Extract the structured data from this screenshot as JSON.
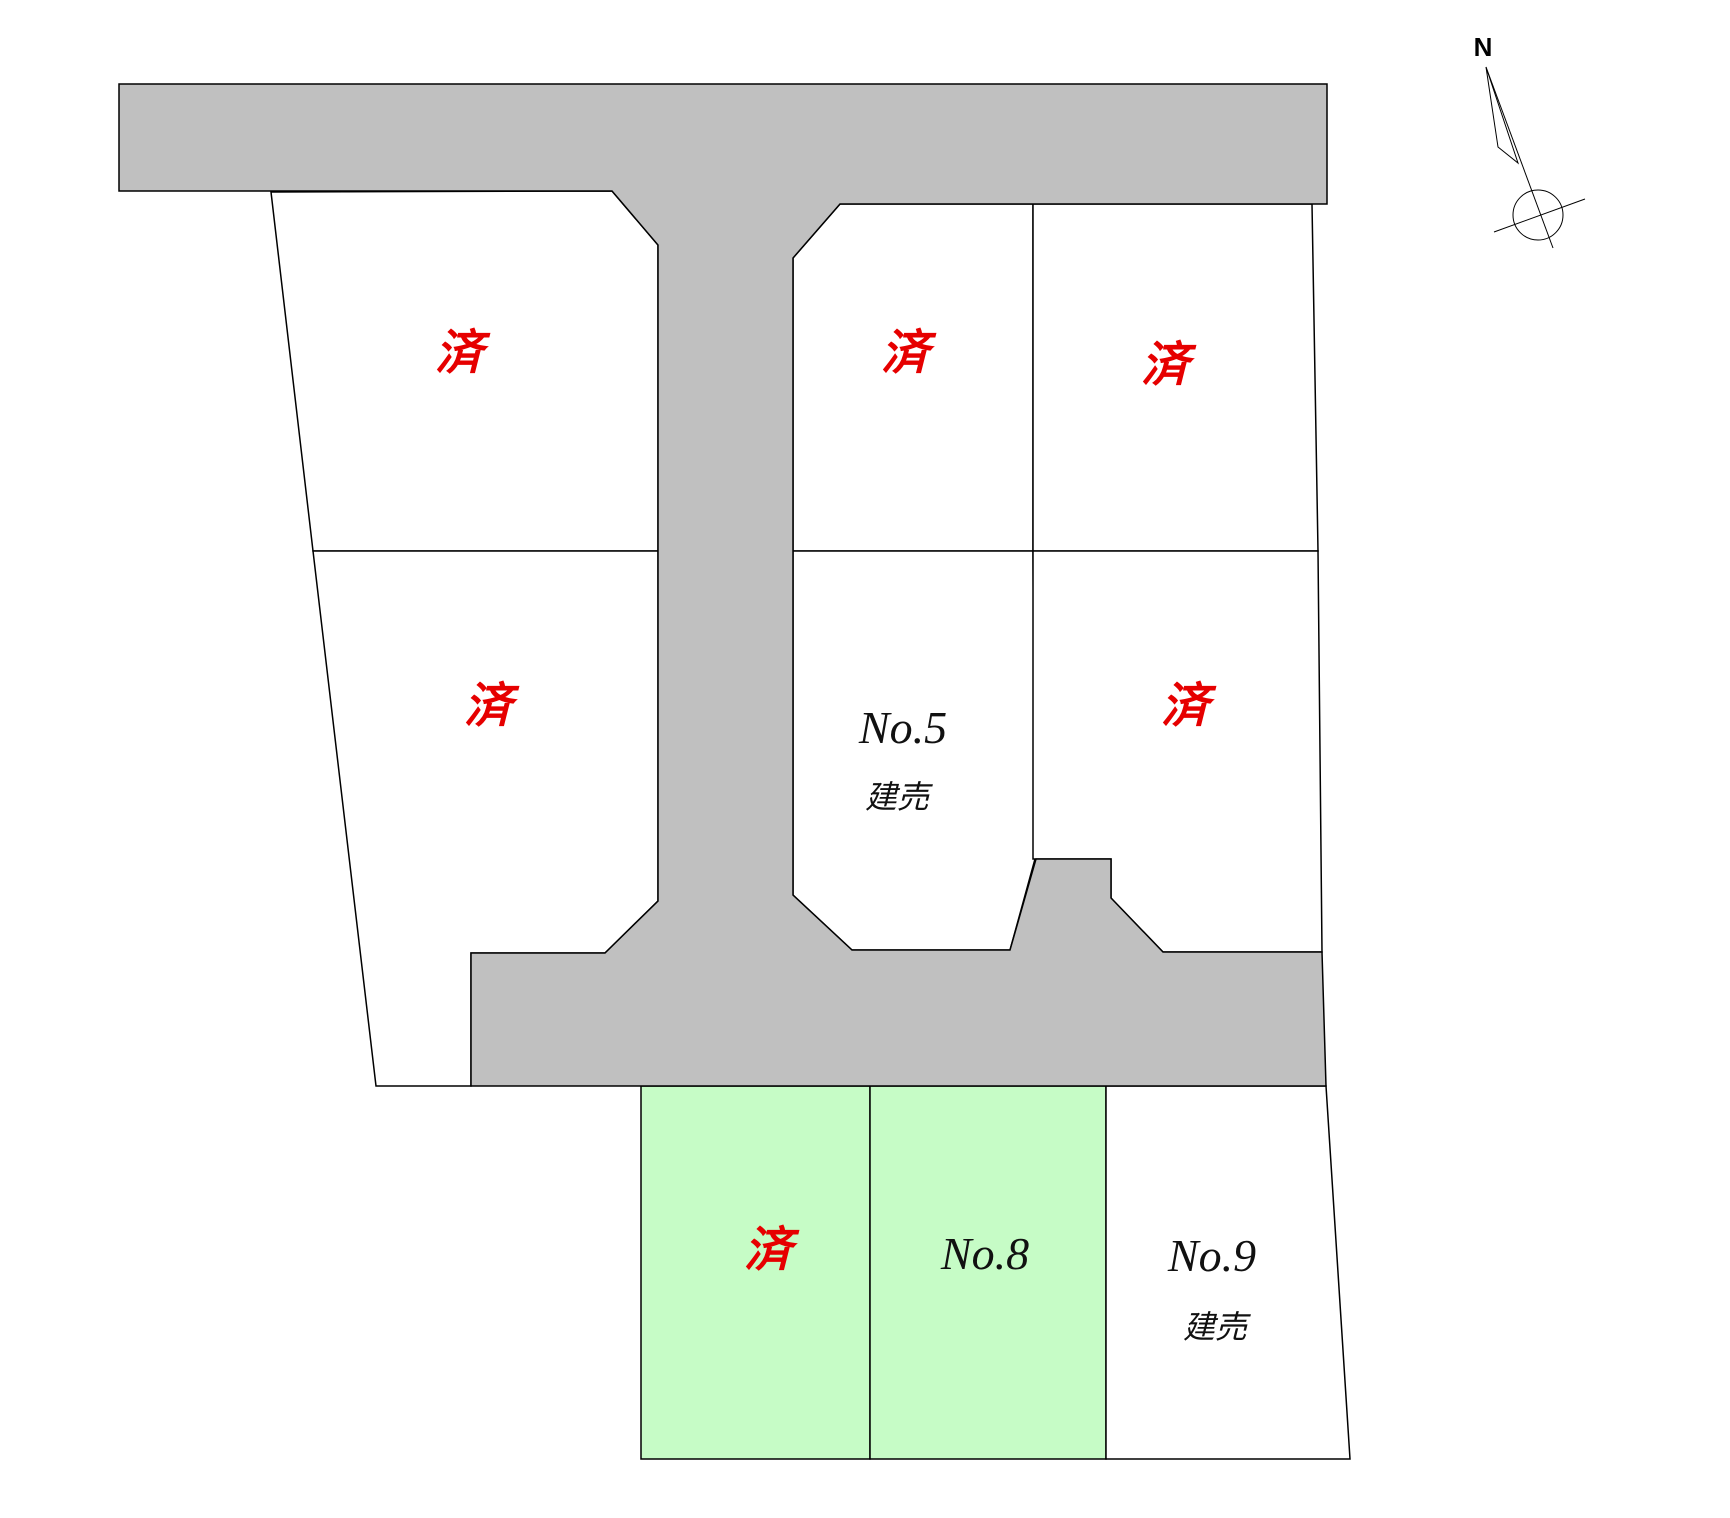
{
  "colors": {
    "road_gray": "#c0c0c0",
    "lot_white": "#ffffff",
    "lot_green": "#c6fcc6",
    "sold_red": "#e60000",
    "label_black": "#111111",
    "outline": "#000000"
  },
  "road": {
    "fill": "#c0c0c0"
  },
  "compass": {
    "label": "N"
  },
  "lots": [
    {
      "id": "lot-top-left",
      "label": "済",
      "status": "sold",
      "fill": "#ffffff",
      "label_color": "#e60000"
    },
    {
      "id": "lot-top-middle",
      "label": "済",
      "status": "sold",
      "fill": "#ffffff",
      "label_color": "#e60000"
    },
    {
      "id": "lot-top-right",
      "label": "済",
      "status": "sold",
      "fill": "#ffffff",
      "label_color": "#e60000"
    },
    {
      "id": "lot-mid-left",
      "label": "済",
      "status": "sold",
      "fill": "#ffffff",
      "label_color": "#e60000"
    },
    {
      "id": "lot-no5",
      "label": "No.5",
      "sublabel": "建売",
      "status": "built-for-sale",
      "fill": "#ffffff",
      "label_color": "#111111"
    },
    {
      "id": "lot-mid-right",
      "label": "済",
      "status": "sold",
      "fill": "#ffffff",
      "label_color": "#e60000"
    },
    {
      "id": "lot-bottom-left",
      "label": "済",
      "status": "sold",
      "fill": "#c6fcc6",
      "label_color": "#e60000"
    },
    {
      "id": "lot-no8",
      "label": "No.8",
      "status": "built-for-sale",
      "fill": "#c6fcc6",
      "label_color": "#111111"
    },
    {
      "id": "lot-no9",
      "label": "No.9",
      "sublabel": "建売",
      "status": "built-for-sale",
      "fill": "#ffffff",
      "label_color": "#111111"
    }
  ]
}
